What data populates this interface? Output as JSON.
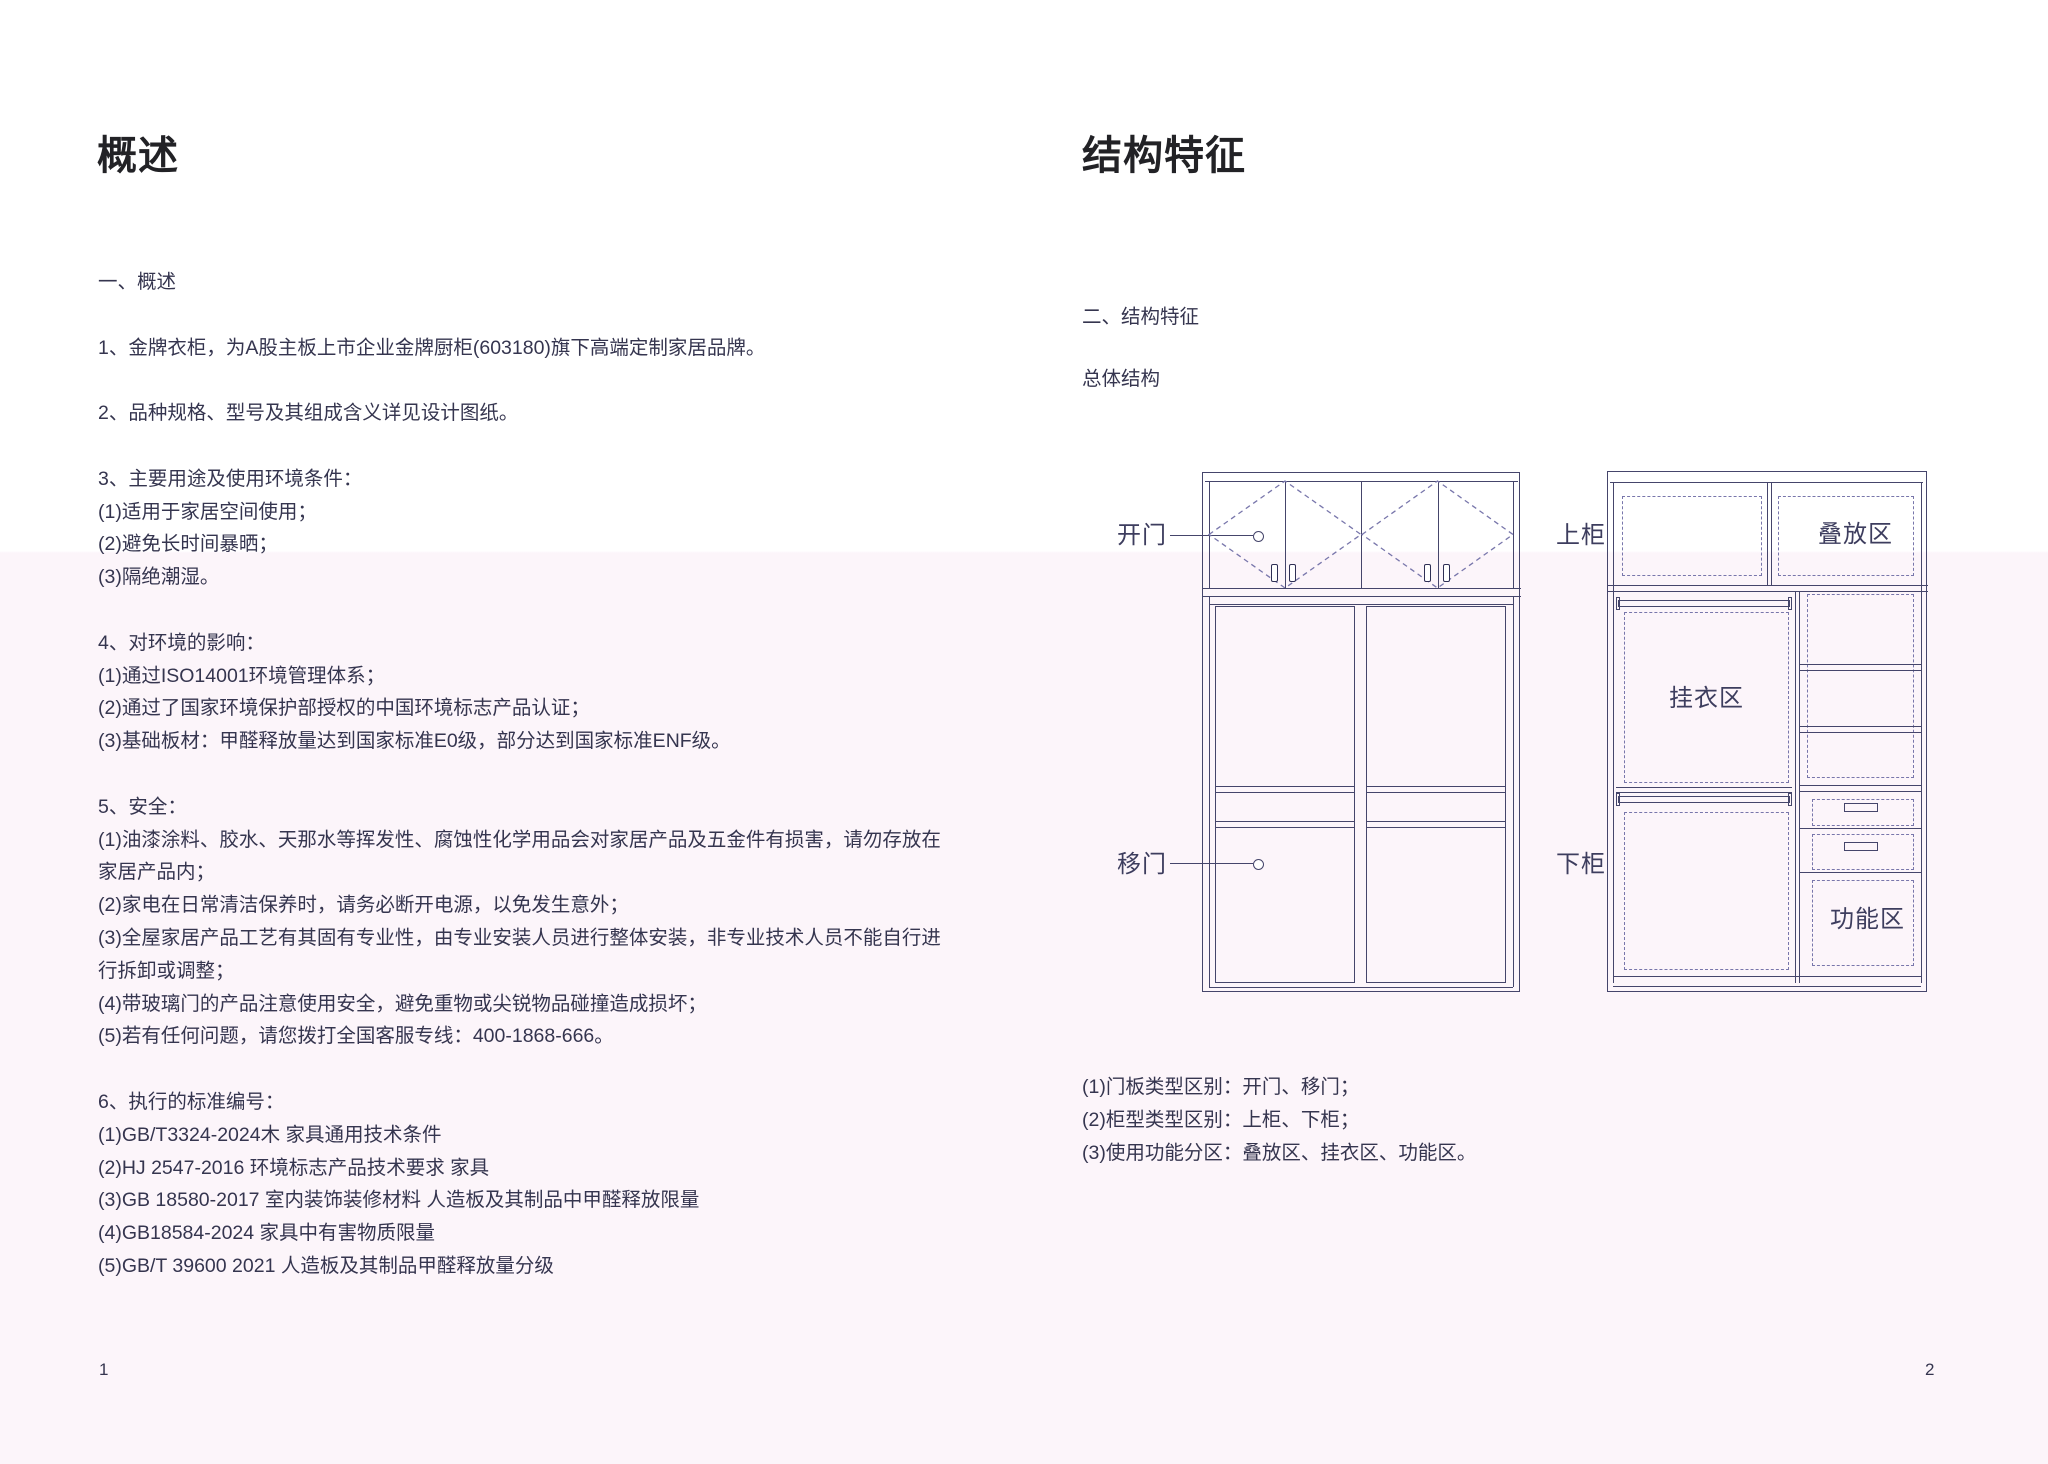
{
  "colors": {
    "page_tint": "#fcf5fa",
    "text": "#35354f",
    "title": "#222226",
    "diagram_line": "#45456b",
    "diagram_dashed": "#7876ab",
    "diagram_label": "#3d3d5e"
  },
  "page_left": {
    "title": "概述",
    "page_number": "1",
    "blocks": [
      [
        "一、概述"
      ],
      [
        "1、金牌衣柜，为A股主板上市企业金牌厨柜(603180)旗下高端定制家居品牌。"
      ],
      [
        "2、品种规格、型号及其组成含义详见设计图纸。"
      ],
      [
        "3、主要用途及使用环境条件：",
        "(1)适用于家居空间使用；",
        "(2)避免长时间暴晒；",
        "(3)隔绝潮湿。"
      ],
      [
        "4、对环境的影响：",
        "(1)通过ISO14001环境管理体系；",
        "(2)通过了国家环境保护部授权的中国环境标志产品认证；",
        "(3)基础板材：甲醛释放量达到国家标准E0级，部分达到国家标准ENF级。"
      ],
      [
        "5、安全：",
        "(1)油漆涂料、胶水、天那水等挥发性、腐蚀性化学用品会对家居产品及五金件有损害，请勿存放在",
        "家居产品内；",
        "(2)家电在日常清洁保养时，请务必断开电源，以免发生意外；",
        "(3)全屋家居产品工艺有其固有专业性，由专业安装人员进行整体安装，非专业技术人员不能自行进",
        "行拆卸或调整；",
        "(4)带玻璃门的产品注意使用安全，避免重物或尖锐物品碰撞造成损坏；",
        "(5)若有任何问题，请您拨打全国客服专线：400-1868-666。"
      ],
      [
        "6、执行的标准编号：",
        "(1)GB/T3324-2024木 家具通用技术条件",
        "(2)HJ 2547-2016 环境标志产品技术要求 家具",
        "(3)GB 18580-2017 室内装饰装修材料 人造板及其制品中甲醛释放限量",
        "(4)GB18584-2024 家具中有害物质限量",
        "(5)GB/T 39600 2021 人造板及其制品甲醛释放量分级"
      ]
    ]
  },
  "page_right": {
    "title": "结构特征",
    "section_heading": "二、结构特征",
    "diagram_caption": "总体结构",
    "page_number": "2",
    "notes": [
      "(1)门板类型区别：开门、移门；",
      "(2)柜型类型区别：上柜、下柜；",
      "(3)使用功能分区：叠放区、挂衣区、功能区。"
    ],
    "diagram": {
      "labels": {
        "open_door": "开门",
        "sliding_door": "移门",
        "upper_cabinet": "上柜",
        "lower_cabinet": "下柜",
        "stacking_zone": "叠放区",
        "hanging_zone": "挂衣区",
        "function_zone": "功能区"
      }
    }
  }
}
